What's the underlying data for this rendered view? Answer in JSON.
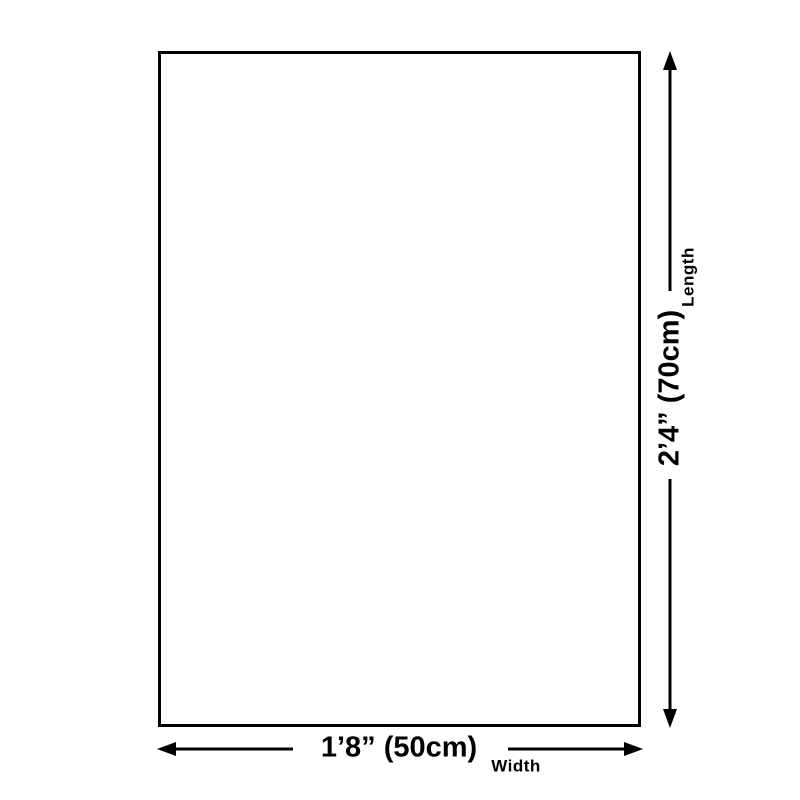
{
  "colors": {
    "line": "#000000",
    "text": "#000000",
    "background": "#ffffff"
  },
  "dimensions": {
    "length": {
      "value": "2’4” (70cm)",
      "label": "Length"
    },
    "width": {
      "value": "1’8” (50cm)",
      "label": "Width"
    }
  }
}
